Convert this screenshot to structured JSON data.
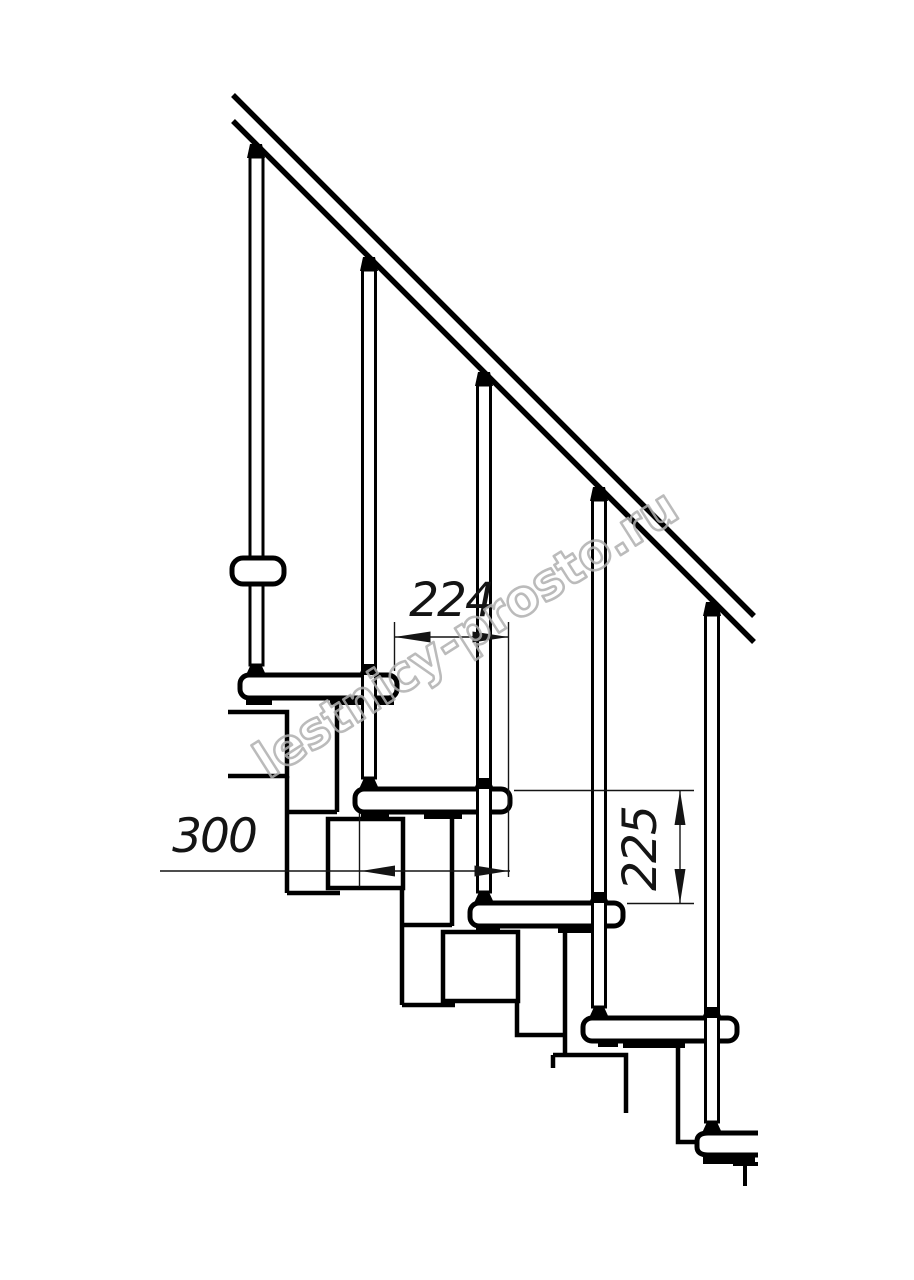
{
  "drawing": {
    "background": "#ffffff",
    "line_color": "#000000",
    "dimension_color": "#141414",
    "watermark_color": "#b0b0b0",
    "watermark_text": "lestnicy-prosto.ru",
    "dimensions": {
      "tread_overlap": "224",
      "tread_depth": "300",
      "riser_height": "225"
    }
  }
}
